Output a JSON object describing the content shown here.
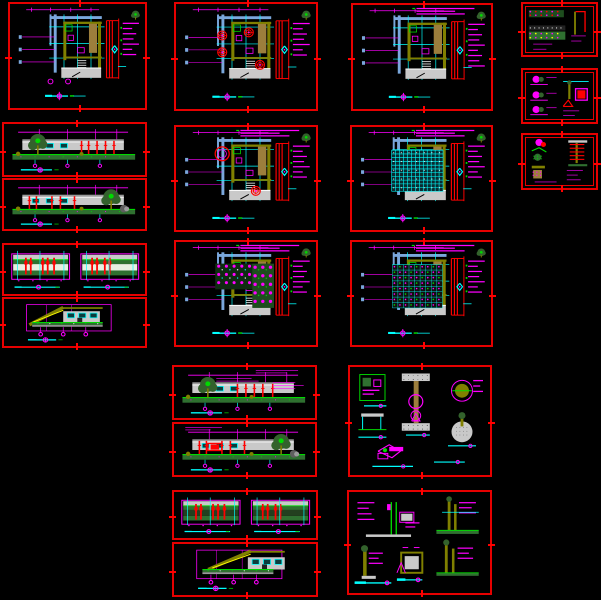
{
  "app": {
    "name": "cad-drawing-canvas",
    "description": "Black model-space canvas containing multiple red-framed architectural drawing sheets (plans, elevations, sections, details). All annotation text is sub-legible CAD lettering rendered as annotation bars.",
    "canvas": {
      "width": 601,
      "height": 600,
      "background": "#000000"
    }
  },
  "palette": {
    "frame_red": "#e60000",
    "red": "#ff0000",
    "magenta": "#ff00ff",
    "cyan": "#00ffff",
    "pale_blue": "#7aa7dc",
    "olive": "#808000",
    "tan": "#9c7e3c",
    "bright_green": "#00d900",
    "dark_green": "#2f7030",
    "tree_green": "#33622c",
    "planting_green": "#1e4d1e",
    "gray_light": "#c9c9c9",
    "gray_mid": "#9a9a9a",
    "gray_dark": "#5f5f5f",
    "white": "#ffffff",
    "yellow": "#ffff00",
    "lattice_fill": "#0a2a30"
  },
  "sheets": [
    {
      "id": "plan-sheet-1",
      "kind": "sitePlan",
      "x": 8,
      "y": 2,
      "w": 139,
      "h": 108,
      "opts": {
        "tree": 1,
        "diamond": 1,
        "doors": 1
      }
    },
    {
      "id": "plan-sheet-2",
      "kind": "sitePlan",
      "x": 174,
      "y": 2,
      "w": 144,
      "h": 109,
      "opts": {
        "tree": 1,
        "diamond": 1,
        "redTrees": [
          [
            0.33,
            0.3
          ],
          [
            0.33,
            0.46
          ],
          [
            0.52,
            0.27
          ],
          [
            0.6,
            0.58
          ]
        ]
      }
    },
    {
      "id": "plan-sheet-3",
      "kind": "sitePlan",
      "x": 351,
      "y": 3,
      "w": 142,
      "h": 108,
      "opts": {
        "tree": 1,
        "diamond": 1,
        "header": 1,
        "dense": 1
      }
    },
    {
      "id": "detail-sheet-small-1",
      "kind": "detailSmall",
      "x": 521,
      "y": 2,
      "w": 77,
      "h": 55,
      "double": 1,
      "opts": {
        "v": 1
      }
    },
    {
      "id": "detail-sheet-small-2",
      "kind": "detailSmall",
      "x": 521,
      "y": 68,
      "w": 77,
      "h": 56,
      "double": 1,
      "opts": {
        "v": 2
      }
    },
    {
      "id": "detail-sheet-small-3",
      "kind": "detailSmall",
      "x": 521,
      "y": 133,
      "w": 77,
      "h": 57,
      "double": 1,
      "opts": {
        "v": 3
      }
    },
    {
      "id": "elevation-sheet-1",
      "kind": "elevation",
      "x": 2,
      "y": 122,
      "w": 145,
      "h": 55,
      "opts": {
        "tree": "left",
        "cols": "right"
      }
    },
    {
      "id": "elevation-sheet-2",
      "kind": "elevation",
      "x": 2,
      "y": 178,
      "w": 145,
      "h": 53,
      "opts": {
        "tree": "right",
        "cols": "left",
        "rock": 1
      }
    },
    {
      "id": "plan-sheet-4",
      "kind": "sitePlan",
      "x": 174,
      "y": 125,
      "w": 144,
      "h": 107,
      "opts": {
        "tree": 1,
        "diamond": 1,
        "header": 1,
        "redTrees": [
          [
            0.57,
            0.62
          ]
        ],
        "arc": 1
      }
    },
    {
      "id": "plan-sheet-5",
      "kind": "sitePlan",
      "x": 350,
      "y": 125,
      "w": 143,
      "h": 107,
      "opts": {
        "tree": 1,
        "diamond": 1,
        "header": 1,
        "lattice": 1
      }
    },
    {
      "id": "elevation-pair-sheet-1",
      "kind": "elevPair",
      "x": 2,
      "y": 243,
      "w": 145,
      "h": 53,
      "opts": {}
    },
    {
      "id": "section-sheet-1",
      "kind": "section",
      "x": 2,
      "y": 297,
      "w": 145,
      "h": 51,
      "opts": {
        "dir": "left"
      }
    },
    {
      "id": "plan-sheet-6",
      "kind": "sitePlan",
      "x": 174,
      "y": 240,
      "w": 144,
      "h": 107,
      "opts": {
        "tree": 1,
        "diamond": 1,
        "header": 1,
        "furniture": 1,
        "planting": 1
      }
    },
    {
      "id": "plan-sheet-7",
      "kind": "sitePlan",
      "x": 350,
      "y": 240,
      "w": 143,
      "h": 107,
      "opts": {
        "tree": 1,
        "diamond": 1,
        "header": 1,
        "dotmatrix": 1
      }
    },
    {
      "id": "elevation-sheet-3",
      "kind": "elevation",
      "x": 172,
      "y": 365,
      "w": 145,
      "h": 55,
      "opts": {
        "tree": "left",
        "cols": "mid",
        "header": "right",
        "scribbles": 1
      }
    },
    {
      "id": "elevation-sheet-4",
      "kind": "elevation",
      "x": 172,
      "y": 422,
      "w": 145,
      "h": 55,
      "opts": {
        "tree": "right",
        "cols": "left",
        "header": "left",
        "redBox": 1,
        "rock": 1
      }
    },
    {
      "id": "detail-sheet-a",
      "kind": "detailsA",
      "x": 348,
      "y": 365,
      "w": 144,
      "h": 112,
      "opts": {}
    },
    {
      "id": "elevation-pair-sheet-2",
      "kind": "elevPair",
      "x": 172,
      "y": 490,
      "w": 146,
      "h": 50,
      "opts": {
        "dark": 1
      }
    },
    {
      "id": "section-sheet-2",
      "kind": "section",
      "x": 172,
      "y": 542,
      "w": 146,
      "h": 55,
      "opts": {
        "dir": "right"
      }
    },
    {
      "id": "detail-sheet-b",
      "kind": "detailsB",
      "x": 347,
      "y": 490,
      "w": 145,
      "h": 105,
      "opts": {}
    }
  ],
  "symbols": {
    "tree_icon": "small green conifer/plan tree symbol at sheet top-right",
    "north_diamond_icon": "cyan diamond orientation symbol",
    "scale_bar": "cyan graphic scale bar with magenta circled section mark",
    "annotation_block": "magenta sub-legible CAD note bars",
    "registration_tick": "red cross tick at each frame edge midpoint"
  }
}
